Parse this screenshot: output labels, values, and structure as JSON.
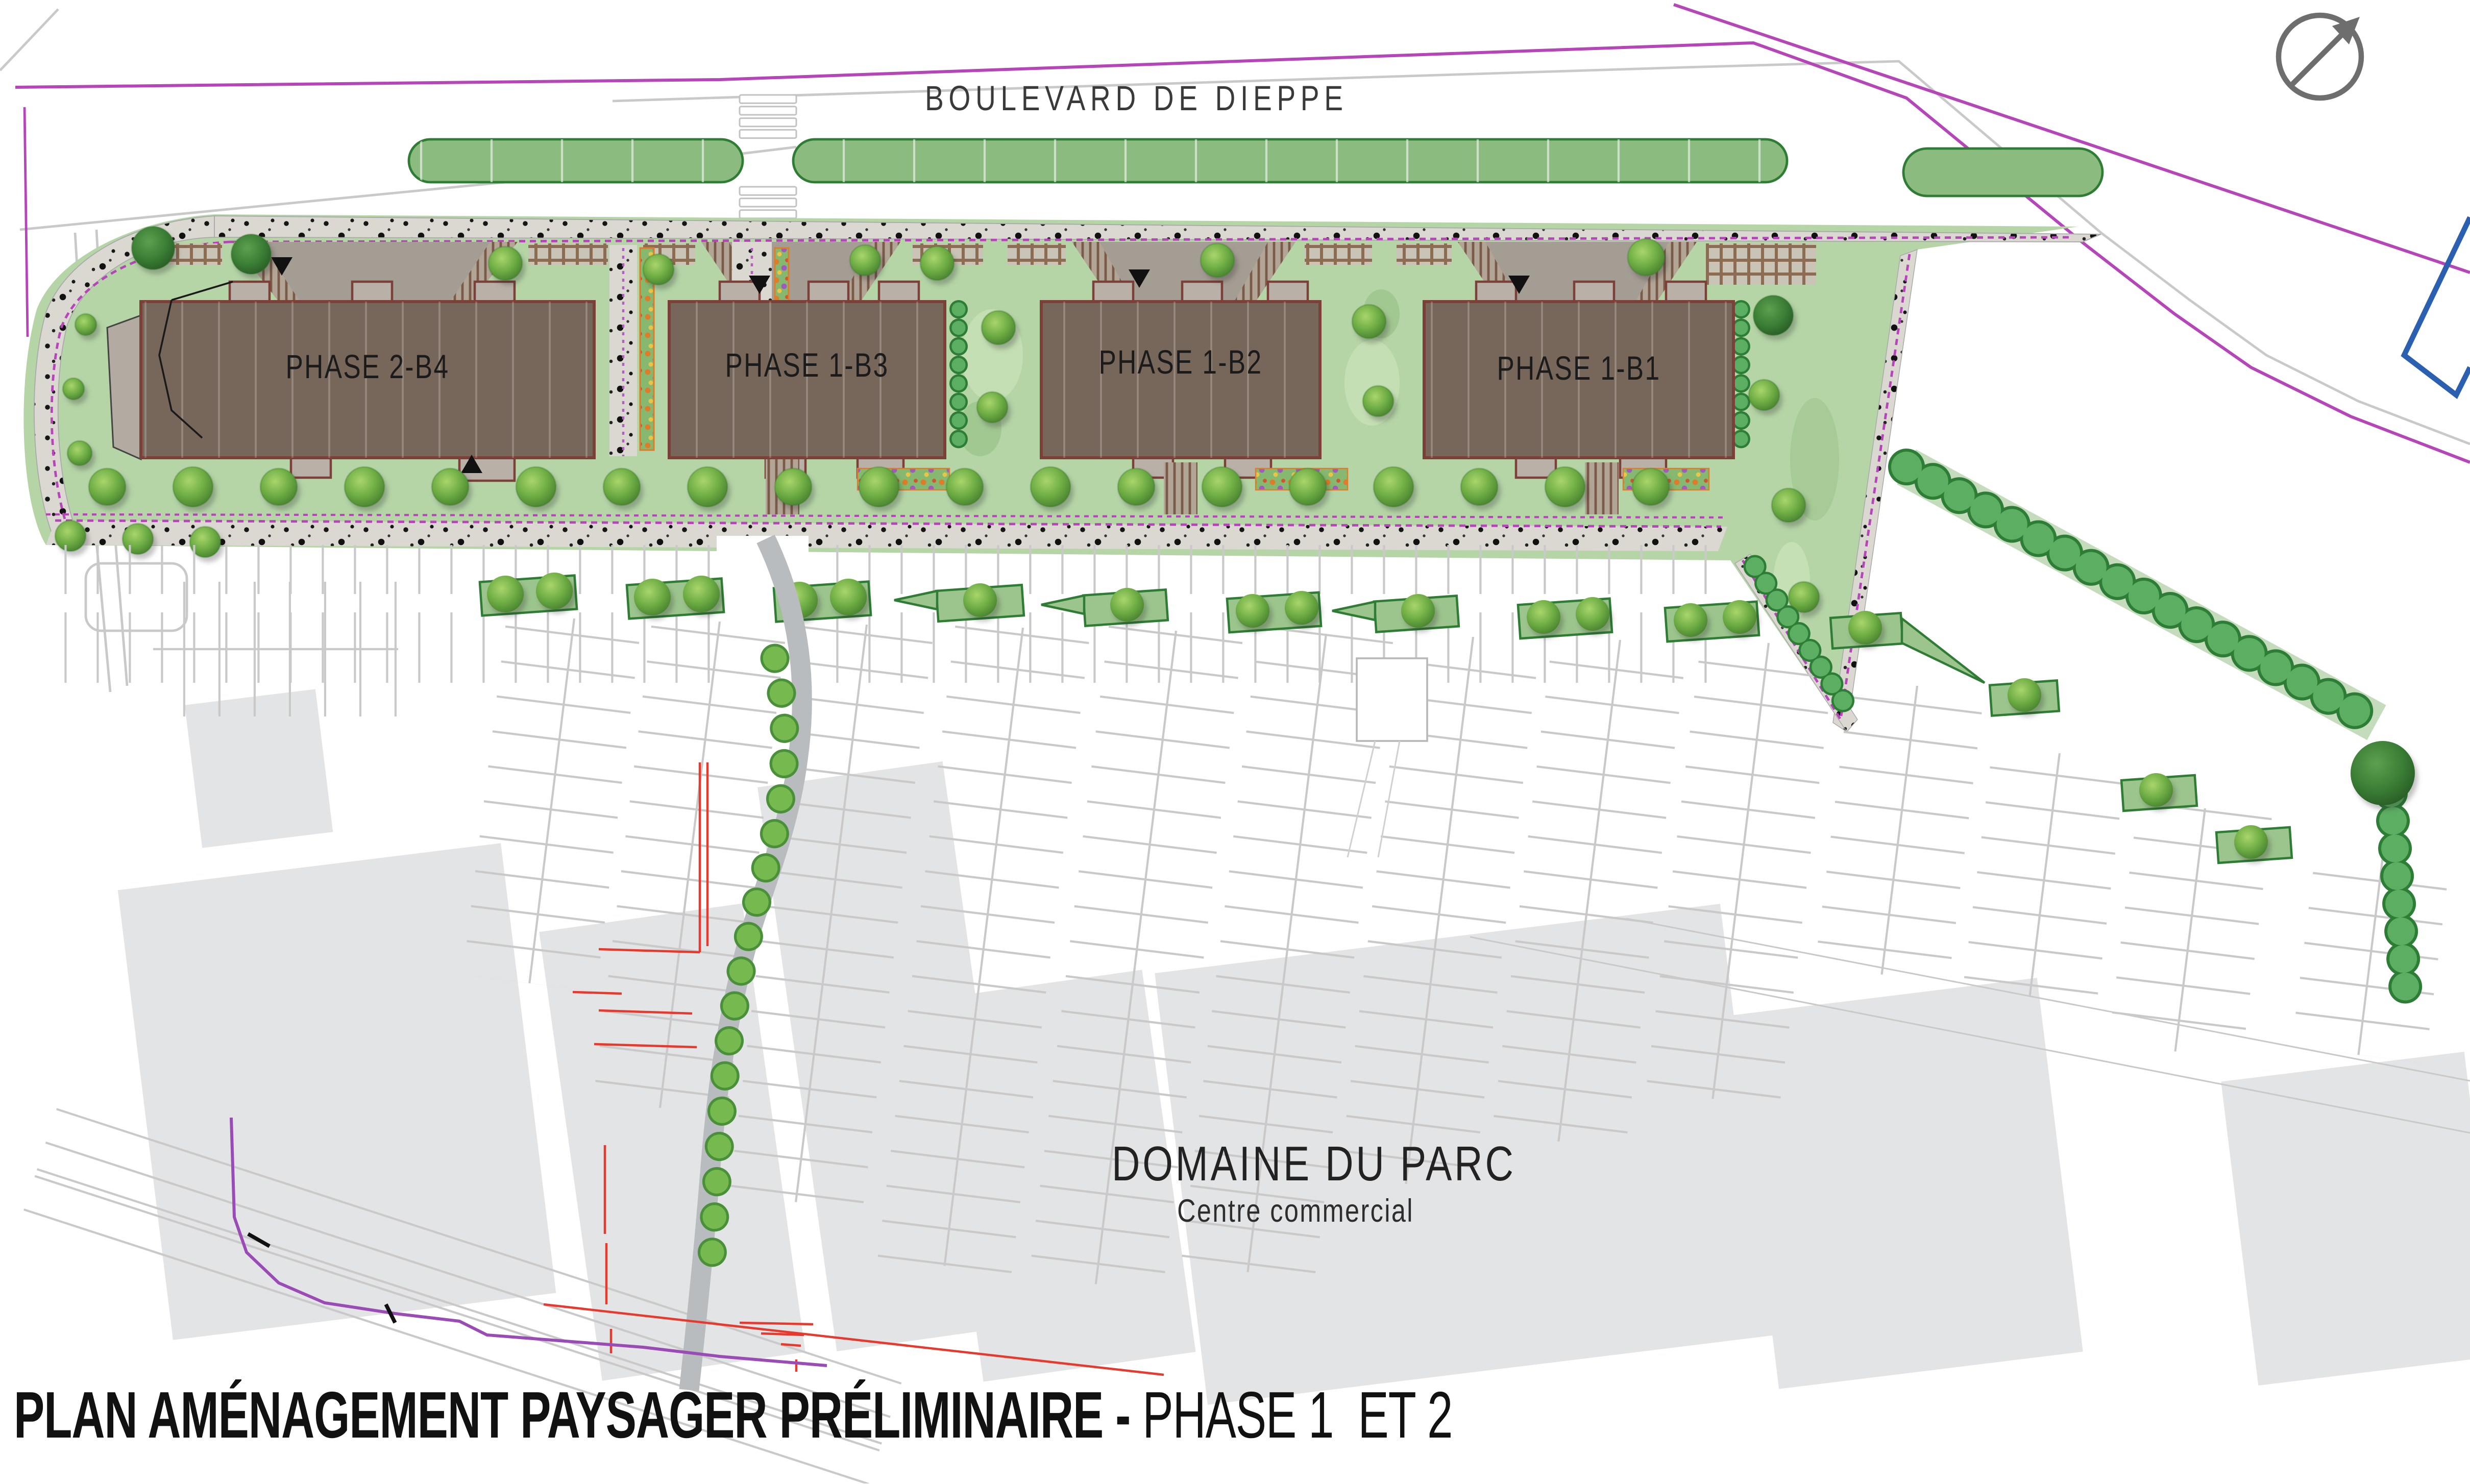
{
  "title": {
    "main": "PLAN AMÉNAGEMENT PAYSAGER PRÉLIMINAIRE - ",
    "phase": "PHASE 1  ET 2"
  },
  "street": {
    "name": "BOULEVARD DE DIEPPE"
  },
  "buildings": [
    {
      "label": "PHASE 2-B4"
    },
    {
      "label": "PHASE 1-B3"
    },
    {
      "label": "PHASE 1-B2"
    },
    {
      "label": "PHASE 1-B1"
    }
  ],
  "commercial_center": {
    "name": "DOMAINE DU PARC",
    "subtitle": "Centre commercial"
  },
  "icons": {
    "north_arrow": "circle-with-northeast-arrow"
  },
  "palette": {
    "lawn": "#b5d5a7",
    "lawn_light": "#c6e0b6",
    "median": "#8cbb80",
    "median_border": "#2f7d35",
    "building": "#77675a",
    "building_outline": "#7b4038",
    "annex": "#b9b1a8",
    "sidewalk": "#dbd8d2",
    "path": "#b9bcbe",
    "existing_building": "#e3e4e5",
    "parking_line": "#c9c9c9",
    "property_line": "#b545b8",
    "demolition_line": "#e8392e",
    "survey_line": "#2b5fb0",
    "hedge": "#5cae63",
    "hedge_outline": "#2e7d36",
    "compass": "#6e6e6e"
  }
}
